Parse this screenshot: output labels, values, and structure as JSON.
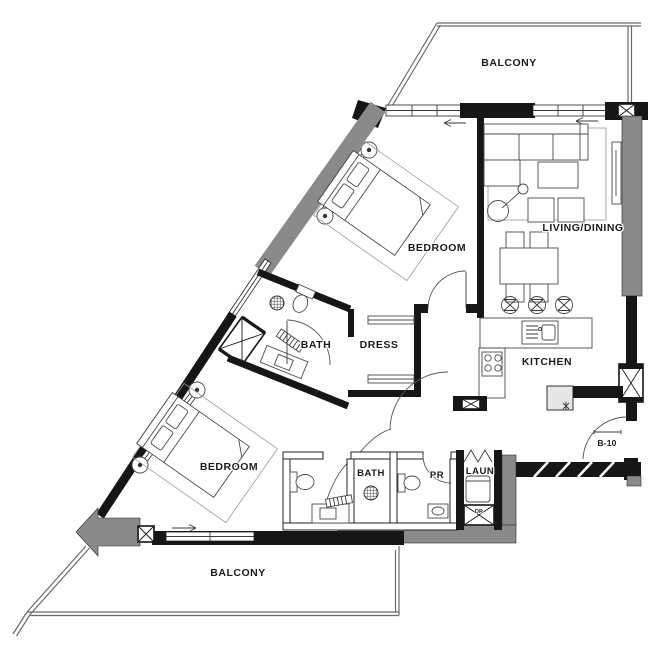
{
  "labels": {
    "balcony_top": "BALCONY",
    "living_dining": "LIVING/DINING",
    "bedroom_top": "BEDROOM",
    "bath_mid": "BATH",
    "dress": "DRESS",
    "kitchen": "KITCHEN",
    "bedroom_bottom": "BEDROOM",
    "bath_bottom": "BATH",
    "powder_room": "PR",
    "laundry": "LAUN",
    "dryer": "DR",
    "unit_number": "B-10",
    "balcony_bottom": "BALCONY"
  },
  "colors": {
    "wall_solid": "#161616",
    "wall_shear_gray": "#8a8a8a",
    "drawing_line": "#3a3a3a",
    "background": "#ffffff"
  },
  "icons": {
    "shaft": "x-box",
    "floor_drain": "crosshatch-circle",
    "bar_stool": "x-circle",
    "fridge_mark": "freeze-asterisk",
    "slide_direction": "arrow"
  }
}
